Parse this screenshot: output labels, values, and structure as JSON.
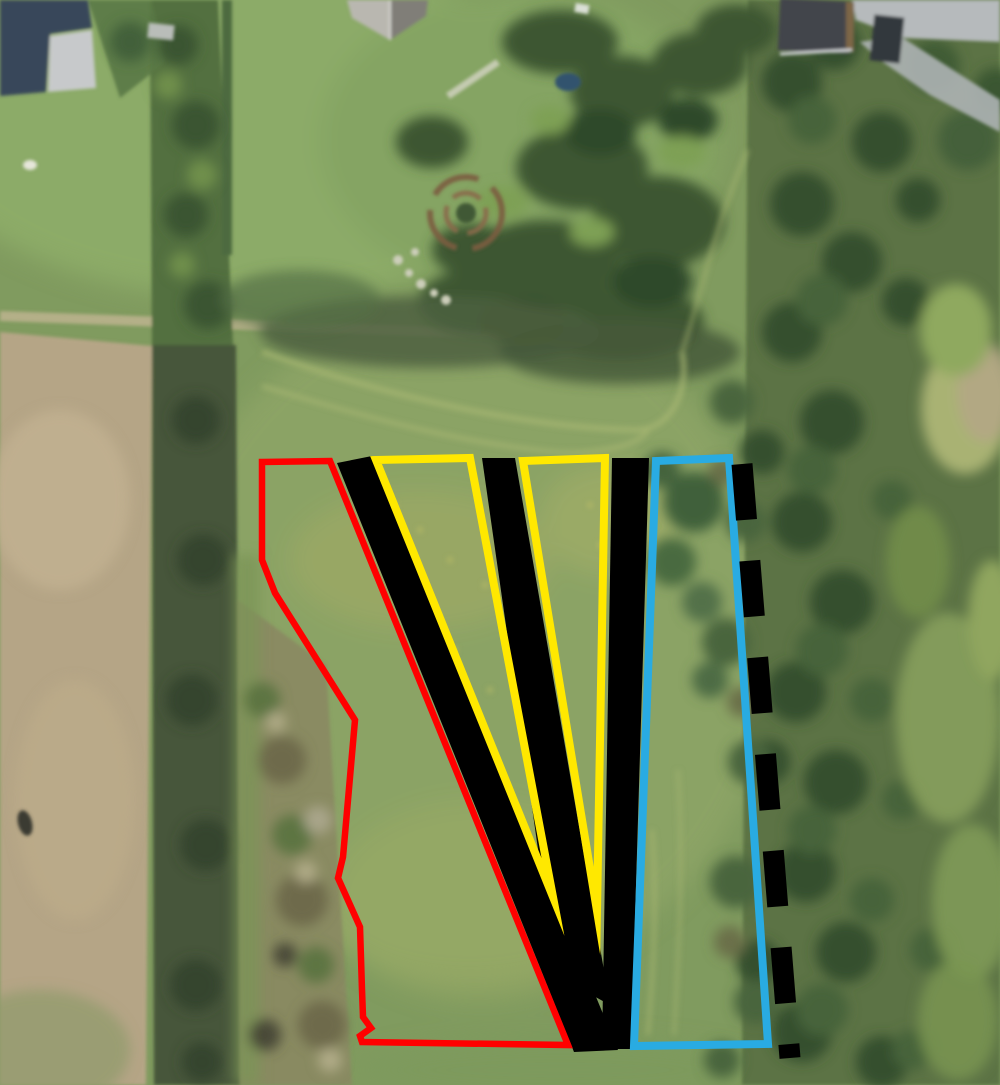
{
  "image": {
    "type": "aerial-photograph",
    "width": 1000,
    "height": 1085,
    "description": "Aerial photograph of pasture and fields bordered by hedgerows and buildings, overlaid with site-plan annotations: a red boundary polygon, three solid black bands converging to a wedge at the bottom, two yellow wedge outlines, a blue strip outline and a thick black dashed boundary line."
  },
  "palette": {
    "grass_base": "#809b5f",
    "meadow_light": "#8da466",
    "lawn_light": "#8cab67",
    "field_tan": "#b5a586",
    "shadow_dark": "#46563b",
    "hedge_green": "#53703f",
    "tree_band": "#5c7345",
    "scrub_brown": "#8a8862",
    "road_gray": "#b6babc",
    "roof_dark": "#39465a",
    "roof_light": "#c7c9cb",
    "building_gray": "#43454b"
  },
  "annotations": {
    "red_boundary": {
      "label": "red-site-boundary",
      "color": "#ff0000",
      "stroke_width": 6.5,
      "points": "262,462 330,461 568,1045 362,1042 360,1036 371,1028 363,1017 362,990 360,927 338,878 343,857 355,720 275,593 262,560"
    },
    "black_band_left": {
      "label": "black-filled-band-left",
      "color": "#000000",
      "points": "337,463 372,456 618,1050 574,1052"
    },
    "black_band_middle": {
      "label": "black-filled-band-middle",
      "color": "#000000",
      "points": "482,458 515,458 610,1005 556,975"
    },
    "black_band_right": {
      "label": "black-filled-band-right",
      "color": "#000000",
      "points": "612,458 649,458 631,1049 602,1049"
    },
    "yellow_wedge_left": {
      "label": "yellow-wedge-left",
      "color": "#ffe800",
      "stroke_width": 8,
      "points": "376,460 470,458 553,897"
    },
    "yellow_wedge_right": {
      "label": "yellow-wedge-right",
      "color": "#ffe800",
      "stroke_width": 8,
      "points": "523,461 605,458 597,911"
    },
    "blue_strip": {
      "label": "blue-strip-boundary",
      "color": "#29abe2",
      "stroke_width": 8,
      "points": "656,461 729,458 768,1044 634,1046"
    },
    "dashed_line": {
      "label": "black-dashed-boundary",
      "color": "#000000",
      "stroke_width": 21,
      "dash_pattern": "56 41",
      "x1": 742,
      "y1": 464,
      "x2": 790,
      "y2": 1058
    }
  }
}
